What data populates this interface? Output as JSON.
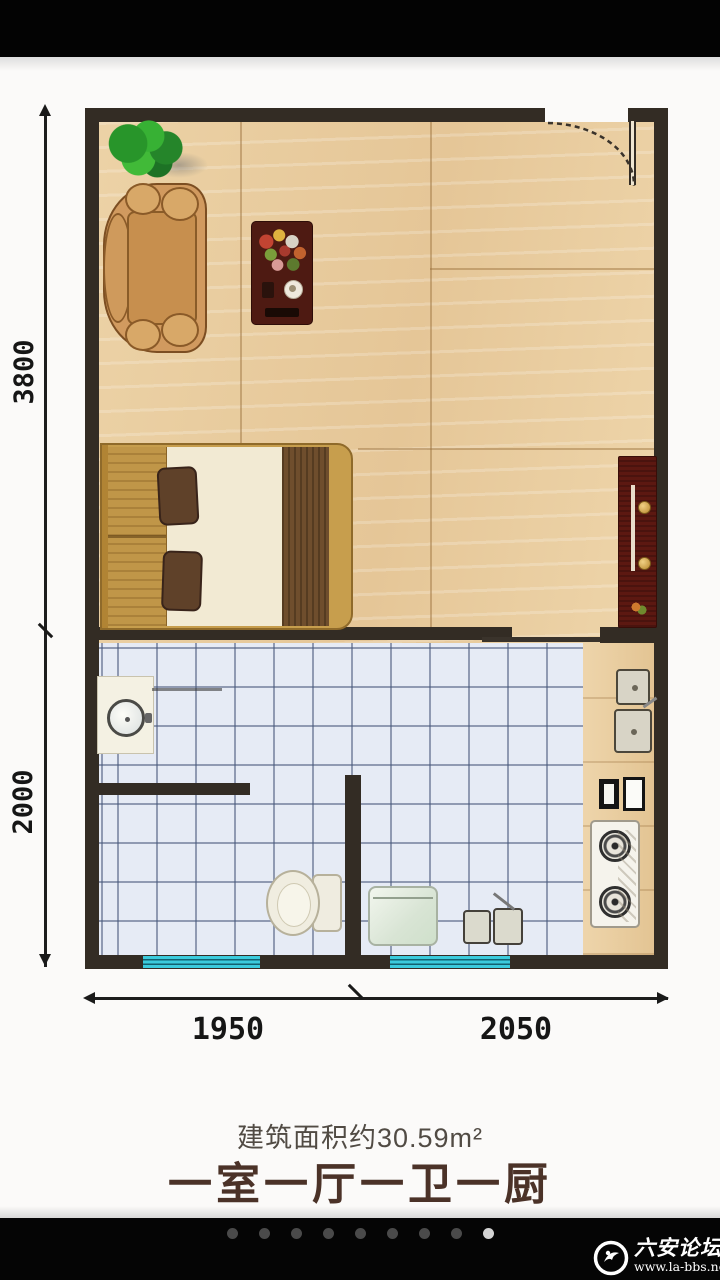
{
  "viewer": {
    "pagination": {
      "total": 9,
      "active_index": 8
    }
  },
  "watermark": {
    "site_name": "六安论坛",
    "url": "www.la-bbs.net"
  },
  "floor_plan": {
    "dimensions": {
      "vertical_top": "3800",
      "vertical_bottom": "2000",
      "horizontal_left": "1950",
      "horizontal_right": "2050"
    },
    "area_label": "建筑面积约30.59m²",
    "layout_label": "一室一厅一卫一厨",
    "furniture": [
      "plant",
      "sofa",
      "coffee-table",
      "bed",
      "tv-cabinet",
      "entry-door",
      "vanity-sink",
      "toilet",
      "washing-machine",
      "double-basin-sink",
      "kitchen-sink",
      "cutting-boards",
      "gas-stove"
    ],
    "colors": {
      "wall": "#332c24",
      "wood_floor": "#e9cda0",
      "tile_floor": "#e6ebf5",
      "window": "#3bcbdc",
      "caption_text": "#4b3228",
      "page_background": "#fbfaf9",
      "bar_background": "#050505"
    }
  }
}
